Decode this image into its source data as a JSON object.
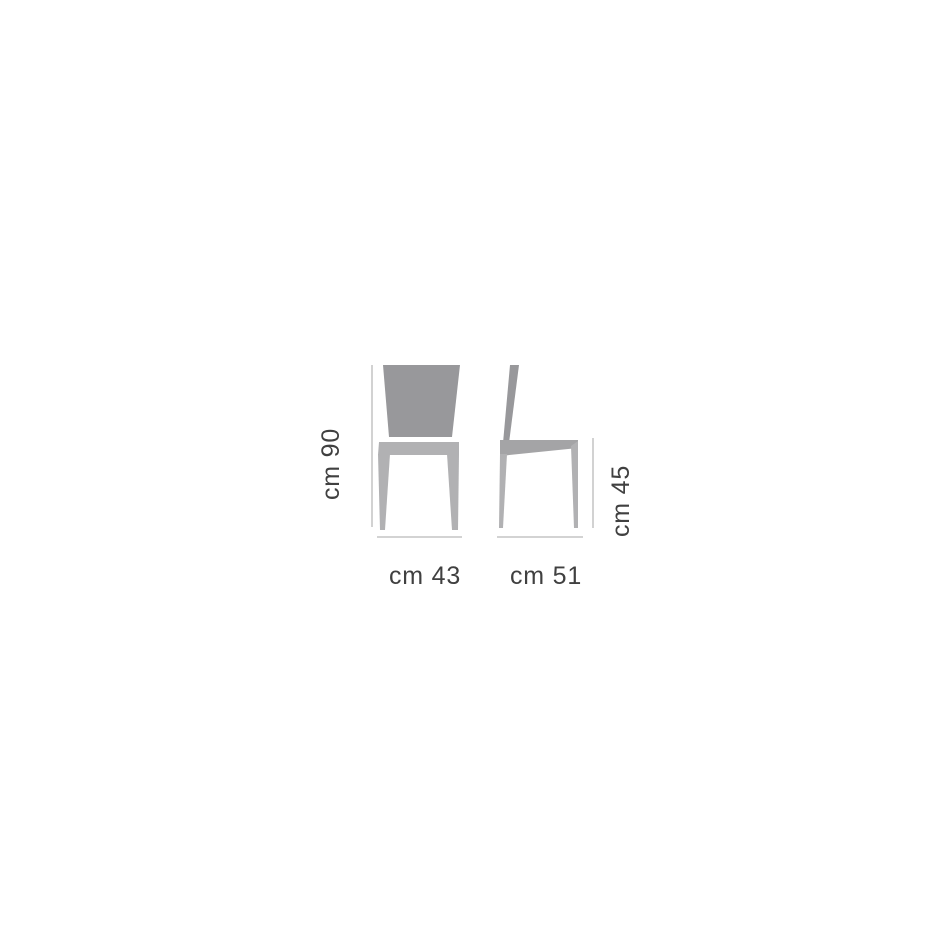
{
  "diagram": {
    "type": "chair-dimension-drawing",
    "labels": {
      "height": "cm 90",
      "seat_height": "cm 45",
      "width": "cm 43",
      "depth": "cm 51"
    },
    "dimensions": {
      "height_cm": 90,
      "seat_height_cm": 45,
      "width_cm": 43,
      "depth_cm": 51
    },
    "views": [
      {
        "name": "front",
        "shows": [
          "width",
          "height"
        ]
      },
      {
        "name": "side",
        "shows": [
          "depth",
          "seat_height"
        ]
      }
    ],
    "colors": {
      "background": "#ffffff",
      "backrest": "#98989b",
      "frame": "#b1b1b3",
      "side_seat": "#a4a4a6",
      "dimension_line": "#b9b9b9",
      "text": "#404040"
    }
  }
}
